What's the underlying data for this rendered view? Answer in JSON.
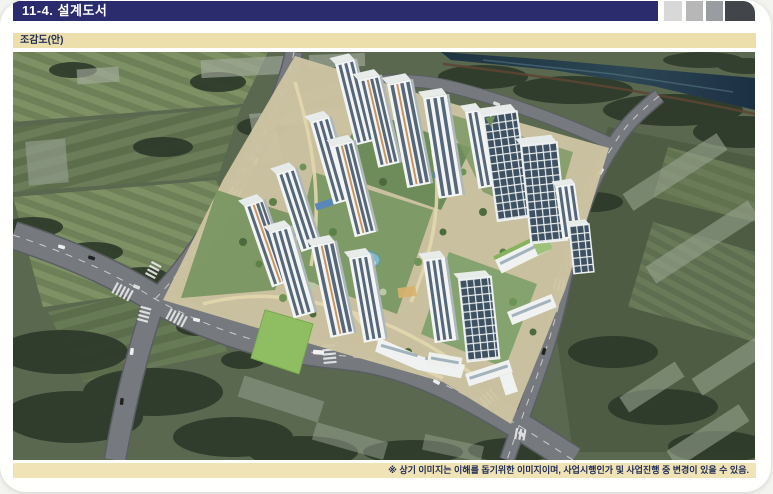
{
  "header": {
    "title": "11-4. 설계도서",
    "decor_square_colors": [
      "#d8d8d8",
      "#b7b7b7",
      "#999da1",
      "#42464b"
    ]
  },
  "section": {
    "label": "조감도(안)"
  },
  "footnote": {
    "text": "※ 상기 이미지는 이해를 돕기위한 이미지이며, 사업시행인가 및 사업진행 중 변경이 있을 수 있음."
  },
  "rendering": {
    "alt": "아파트 단지 조감도(안) - 고층 아파트 타워, 중앙 조경, 주변 도로·농경지·하천 항공 투시 이미지"
  },
  "palette": {
    "header_bg": "#2b2c6e",
    "bar_beige": "#ecdfab",
    "note_beige": "#f0e3b6",
    "text_navy": "#1f2b56",
    "grass": "#59684e",
    "river": "#233844",
    "road": "#767a7e",
    "tower_body": "#f3f5f5",
    "tower_glass": "#45586b",
    "site_ground": "#cfc5a2"
  }
}
